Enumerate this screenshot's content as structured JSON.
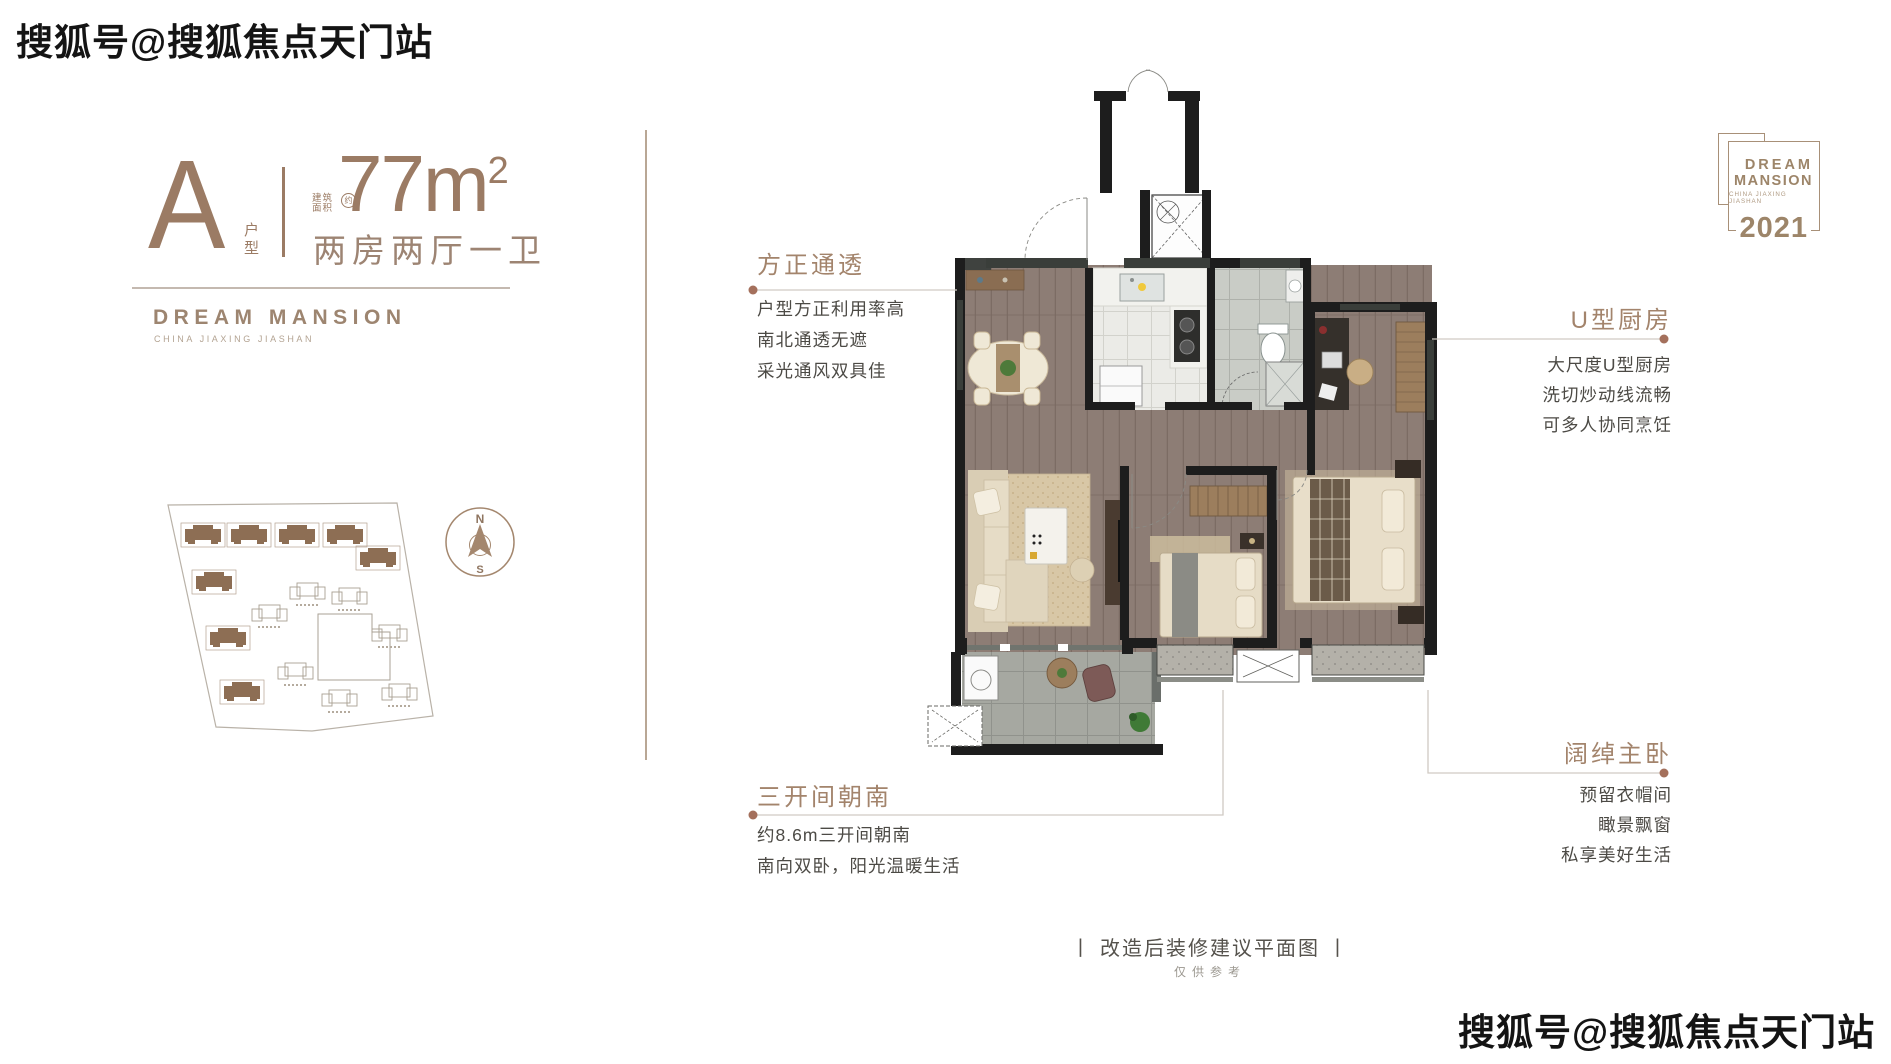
{
  "watermarks": {
    "top_left": "搜狐号@搜狐焦点天门站",
    "bottom_right": "搜狐号@搜狐焦点天门站"
  },
  "unit_card": {
    "type_letter": "A",
    "type_label": "户型",
    "area_prefix_top": "建筑",
    "area_prefix_bottom": "面积",
    "area_prefix_circle": "约",
    "area_value": "77m",
    "area_superscript": "2",
    "rooms_summary": "两房两厅一卫",
    "brand_name": "DREAM MANSION",
    "brand_subtitle": "CHINA JIAXING JIASHAN"
  },
  "compass": {
    "north_label": "N",
    "south_label": "S"
  },
  "callouts": {
    "square_transparent": {
      "title": "方正通透",
      "lines": [
        "户型方正利用率高",
        "南北通透无遮",
        "采光通风双具佳"
      ]
    },
    "u_kitchen": {
      "title": "U型厨房",
      "lines": [
        "大尺度U型厨房",
        "洗切炒动线流畅",
        "可多人协同烹饪"
      ]
    },
    "three_bays_south": {
      "title": "三开间朝南",
      "lines": [
        "约8.6m三开间朝南",
        "南向双卧，阳光温暖生活"
      ]
    },
    "master_bedroom": {
      "title": "阔绰主卧",
      "lines": [
        "预留衣帽间",
        "瞰景飘窗",
        "私享美好生活"
      ]
    }
  },
  "caption": {
    "main": "丨 改造后装修建议平面图 丨",
    "note": "仅供参考"
  },
  "logo": {
    "line1": "DREAM",
    "line2": "MANSION",
    "line3": "CHINA JIAXING JIASHAN",
    "year": "2021"
  },
  "colors": {
    "accent_brown": "#9b7b64",
    "callout_title": "#a3846c",
    "body_text": "#4c4a45",
    "leader_line": "#d0cac3",
    "leader_dot": "#a4705c",
    "wall_black": "#1d1d1d",
    "wood_floor": "#8d7d75"
  }
}
